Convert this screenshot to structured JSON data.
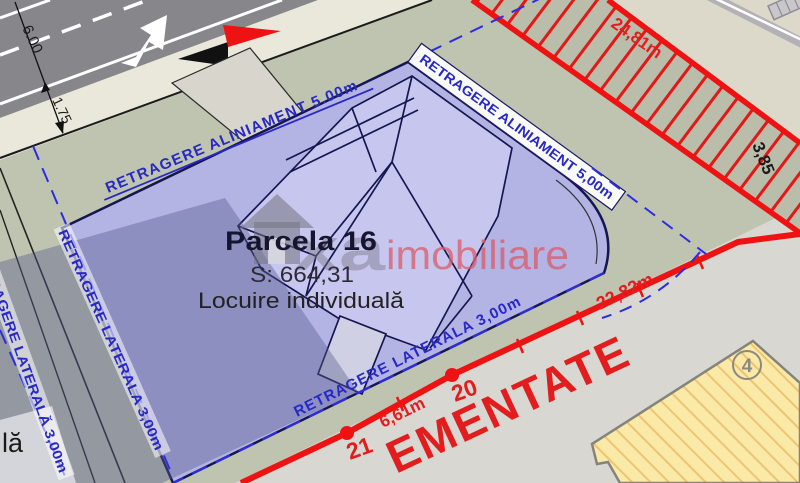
{
  "map": {
    "parcel": {
      "title": "Parcela 16",
      "area": "S: 664,31",
      "use": "Locuire individuală"
    },
    "setbacks": {
      "alignment_left": "RETRAGERE ALINIAMENT 5.00m",
      "alignment_right": "RETRAGERE ALINIAMENT 5,00m",
      "lateral_bottom": "RETRAGERE LATERALA 3,00m",
      "lateral_left_inner": "RETRAGERE LATERALA 3,00m",
      "lateral_left_outer": "RETRAGERE LATERALĂ 3,00m"
    },
    "dimensions": {
      "road_width": "6.00",
      "sidewalk_width": "1.75",
      "boundary_top": "24,81m",
      "boundary_corner": "3,85",
      "boundary_right": "22,82m",
      "boundary_bottom_segment": "6,61m"
    },
    "vertices": {
      "v20": "20",
      "v21": "21"
    },
    "annotations": {
      "zone_text": "EMENTATE",
      "neighbor_building_no": "4",
      "neighbor_label_fragment": "lă"
    },
    "watermark": {
      "gray_text": "xa",
      "accent_text": "imobiliare"
    },
    "colors": {
      "parcel_fill": "#b3b3e4",
      "house_fill": "#c6c6ee",
      "setback_blue": "#2828c8",
      "boundary_red": "#ea1111",
      "building_yellow": "#fbe9a7",
      "road_gray": "#87868b",
      "sidewalk_beige": "#eae7db",
      "ground_green": "#bfc4b1"
    }
  }
}
